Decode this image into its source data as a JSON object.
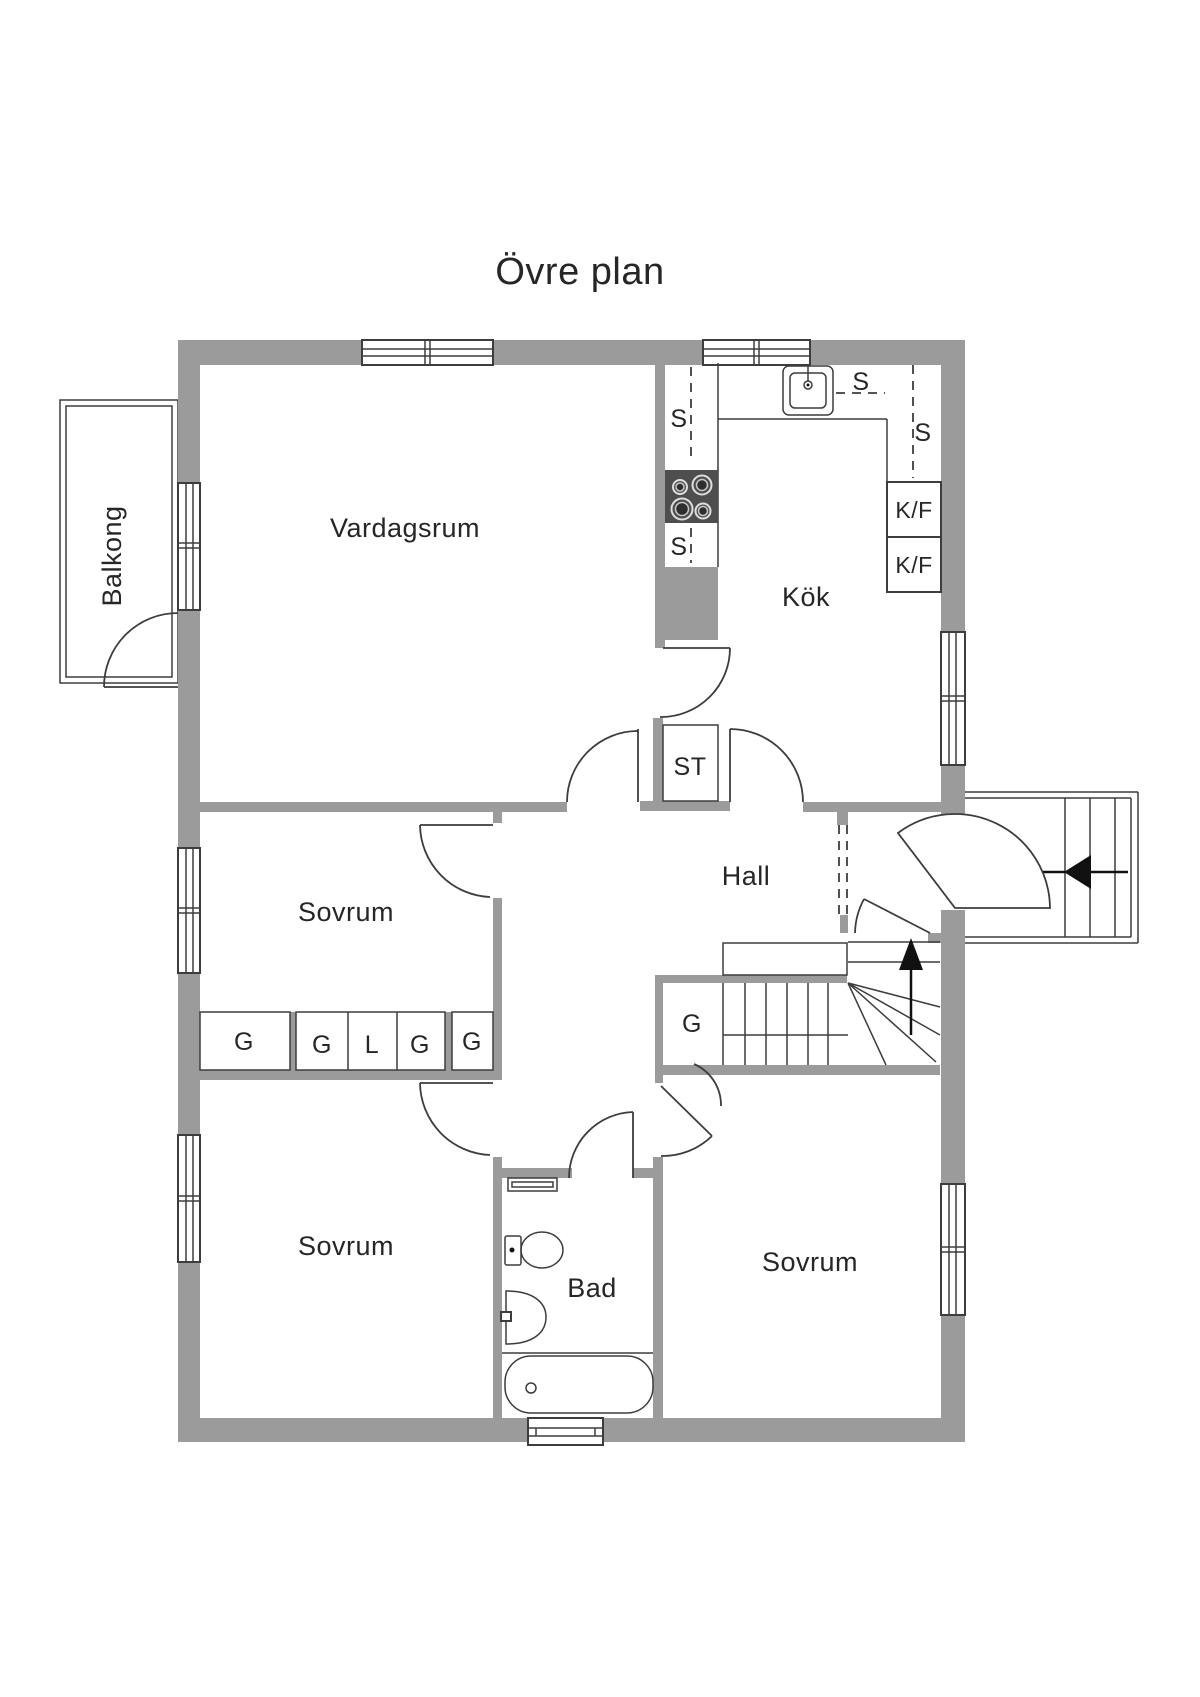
{
  "title": "Övre plan",
  "rooms": {
    "balcony": "Balkong",
    "living_room": "Vardagsrum",
    "kitchen": "Kök",
    "hall": "Hall",
    "bedroom_1": "Sovrum",
    "bedroom_2": "Sovrum",
    "bedroom_3": "Sovrum",
    "bathroom": "Bad"
  },
  "closets": {
    "cleaning": "ST",
    "stair_wardrobe": "G",
    "wardrobe_1": "G",
    "wardrobe_2": "G",
    "linen": "L",
    "wardrobe_3": "G",
    "wardrobe_4": "G"
  },
  "kitchen_units": {
    "pantry_upper": "S",
    "pantry_lower": "S",
    "counter_wall": "S",
    "counter_side": "S",
    "fridge_freezer_upper": "K/F",
    "fridge_freezer_lower": "K/F"
  },
  "colors": {
    "wall": "#9b9b9b",
    "line": "#3d3d3d",
    "text": "#262626",
    "stove": "#4e4e4e"
  }
}
